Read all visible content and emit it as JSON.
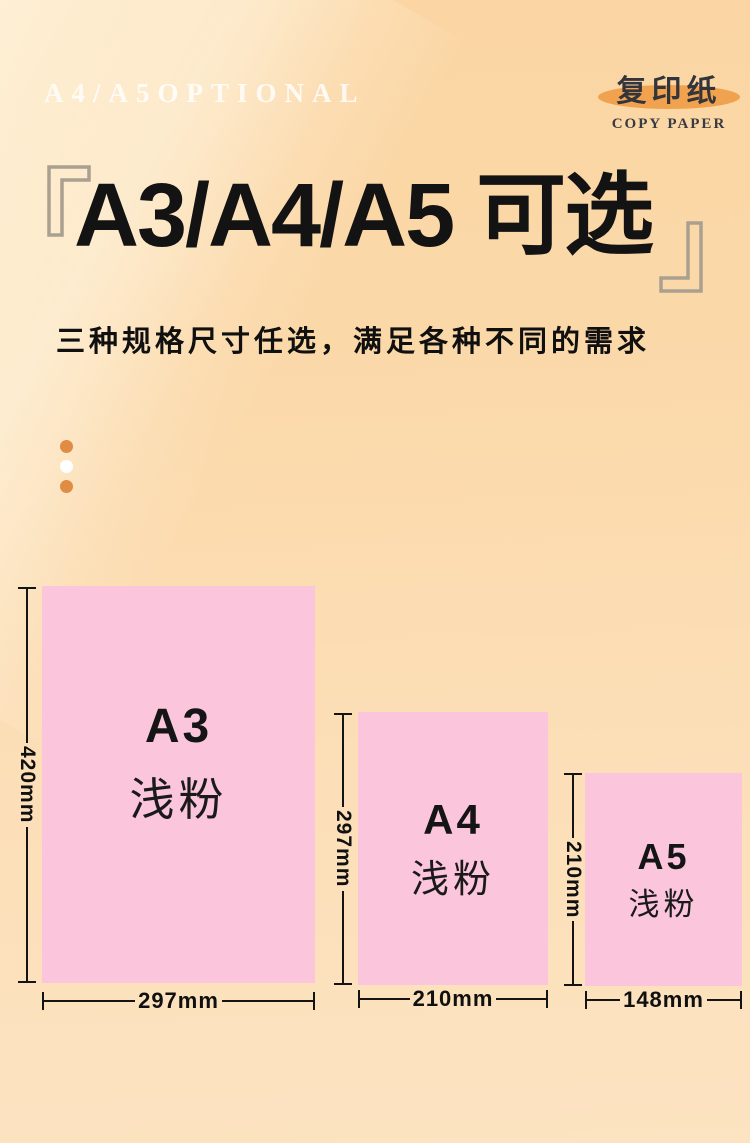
{
  "page": {
    "watermark": "A4/A5OPTIONAL",
    "badge": {
      "title": "复印纸",
      "subtitle": "COPY PAPER"
    },
    "title": "A3/A4/A5 可选",
    "subtitle": "三种规格尺寸任选，满足各种不同的需求",
    "papers": [
      {
        "id": "a3",
        "size_label": "A3",
        "color_label": "浅粉",
        "height_mm": "420mm",
        "width_mm": "297mm"
      },
      {
        "id": "a4",
        "size_label": "A4",
        "color_label": "浅粉",
        "height_mm": "297mm",
        "width_mm": "210mm"
      },
      {
        "id": "a5",
        "size_label": "A5",
        "color_label": "浅粉",
        "height_mm": "210mm",
        "width_mm": "148mm"
      }
    ],
    "colors": {
      "background_top": "#fbd6a4",
      "background_bottom": "#fce3c1",
      "paper_pink": "#fbc5db",
      "badge_ellipse_orange": "#f1a24f",
      "dot_orange": "#e08c44",
      "bracket_gray": "#a9a08f",
      "text_black": "#141414"
    }
  }
}
